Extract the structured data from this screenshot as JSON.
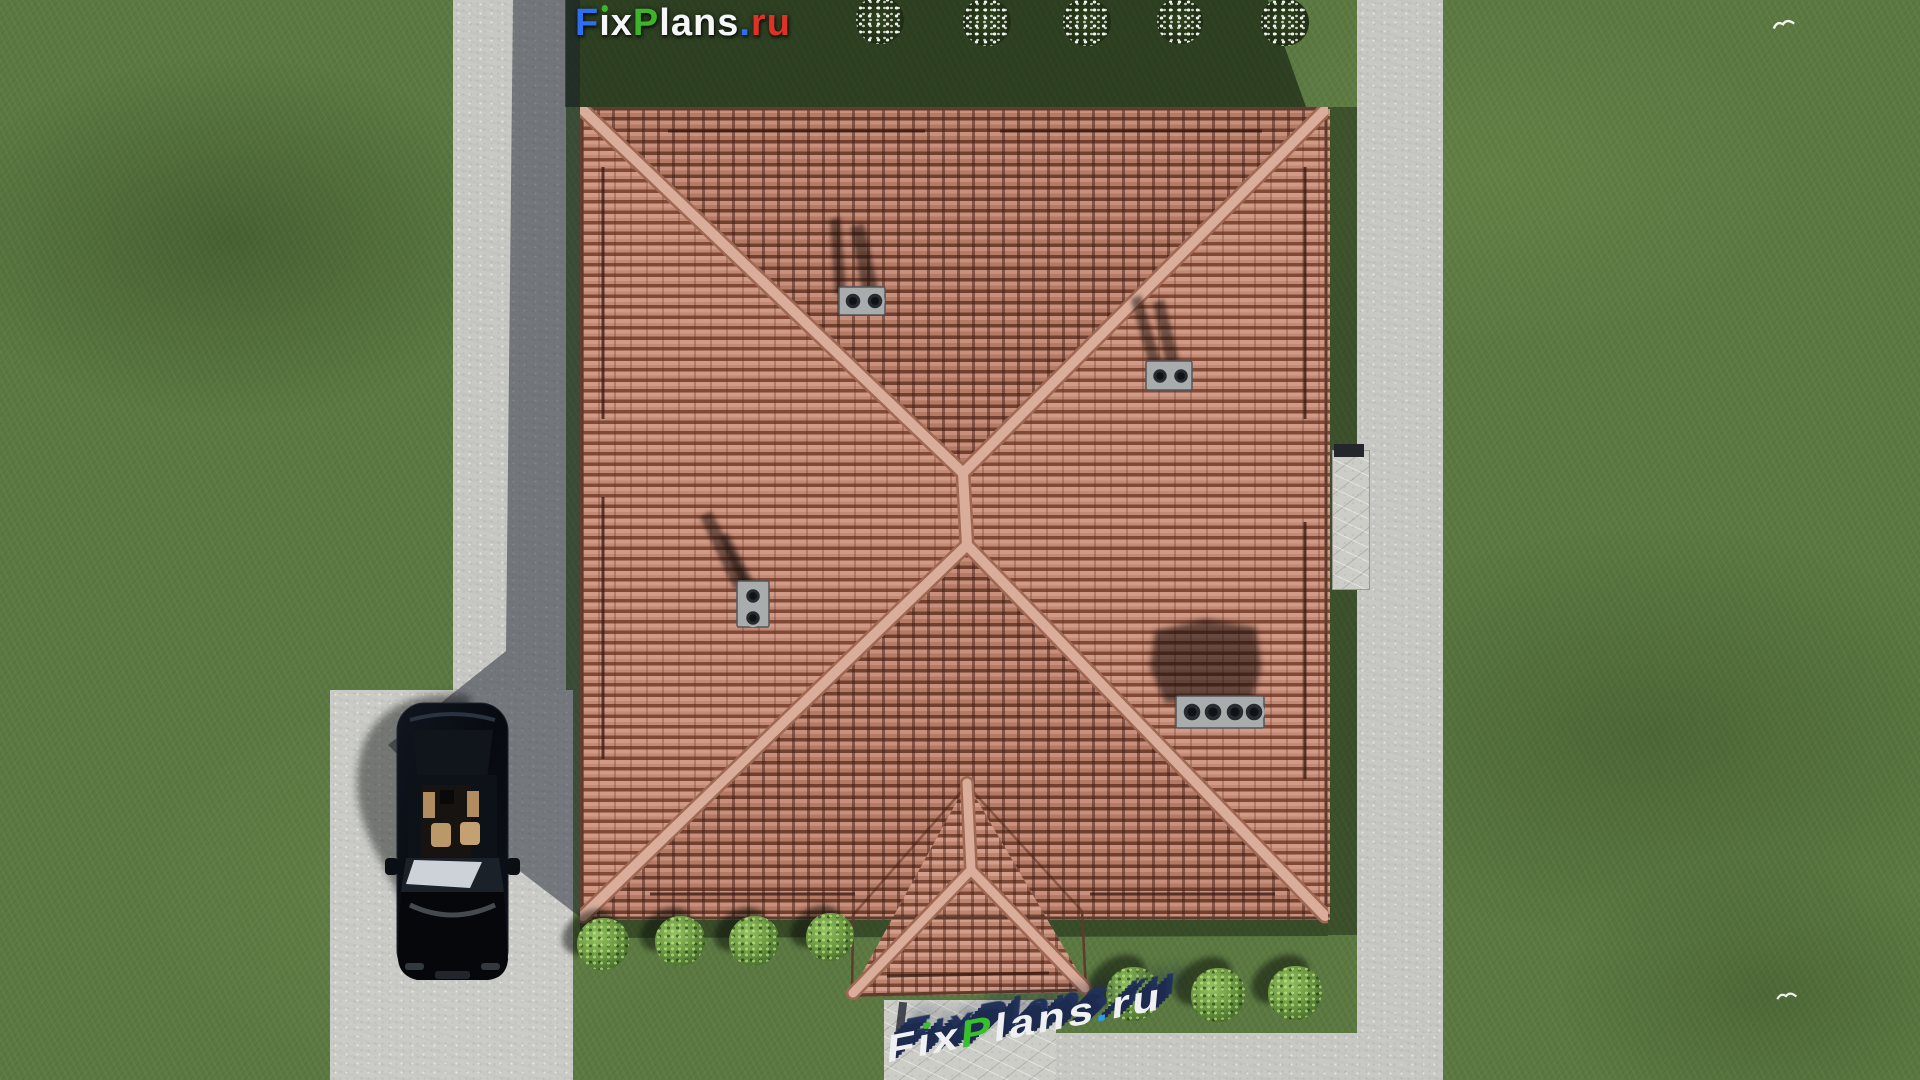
{
  "brand": {
    "top_logo": {
      "text": "FixPlans.ru",
      "letters": [
        {
          "ch": "F",
          "color": "#2e6ff2"
        },
        {
          "ch": "i",
          "color": "#f4f6f8",
          "dot": "#3cb52a"
        },
        {
          "ch": "x",
          "color": "#f4f6f8"
        },
        {
          "ch": "P",
          "color": "#3cb52a"
        },
        {
          "ch": "l",
          "color": "#f4f6f8"
        },
        {
          "ch": "a",
          "color": "#f4f6f8"
        },
        {
          "ch": "n",
          "color": "#f4f6f8"
        },
        {
          "ch": "s",
          "color": "#f4f6f8"
        },
        {
          "ch": ".",
          "color": "#2e6ff2"
        },
        {
          "ch": "r",
          "color": "#e03126"
        },
        {
          "ch": "u",
          "color": "#e03126"
        }
      ]
    },
    "ground_watermark": {
      "text": "FixPlans.ru",
      "extrusion_color": "#1d2a4e",
      "letters": [
        {
          "ch": "F",
          "color": "#eef0f2"
        },
        {
          "ch": "i",
          "color": "#eef0f2",
          "dot": "#35c02c"
        },
        {
          "ch": "x",
          "color": "#eef0f2"
        },
        {
          "ch": "P",
          "color": "#35c02c"
        },
        {
          "ch": "l",
          "color": "#eef0f2"
        },
        {
          "ch": "a",
          "color": "#eef0f2"
        },
        {
          "ch": "n",
          "color": "#eef0f2"
        },
        {
          "ch": "s",
          "color": "#eef0f2"
        },
        {
          "ch": ".",
          "color": "#2a9df4"
        },
        {
          "ch": "r",
          "color": "#eef0f2"
        },
        {
          "ch": "u",
          "color": "#eef0f2"
        }
      ]
    }
  },
  "scene": {
    "view": "top-down aerial 3D render of a house plot",
    "counts": {
      "flowering_shrubs_top_row": 5,
      "green_shrubs_bottom_left": 4,
      "green_shrubs_bottom_right": 3,
      "roof_vent_groups": 4,
      "cars": 1,
      "birds": 2
    }
  },
  "palette": {
    "grass": "#5a7840",
    "grass_shadow": "rgba(12,18,10,0.55)",
    "concrete": "#c8c9c4",
    "roof_tile_light": "#d09a86",
    "roof_tile_dark": "#71402f",
    "ridge_cap": "#d9ad99",
    "car_body": "#0a0d14",
    "car_interior": "#bb9868"
  }
}
